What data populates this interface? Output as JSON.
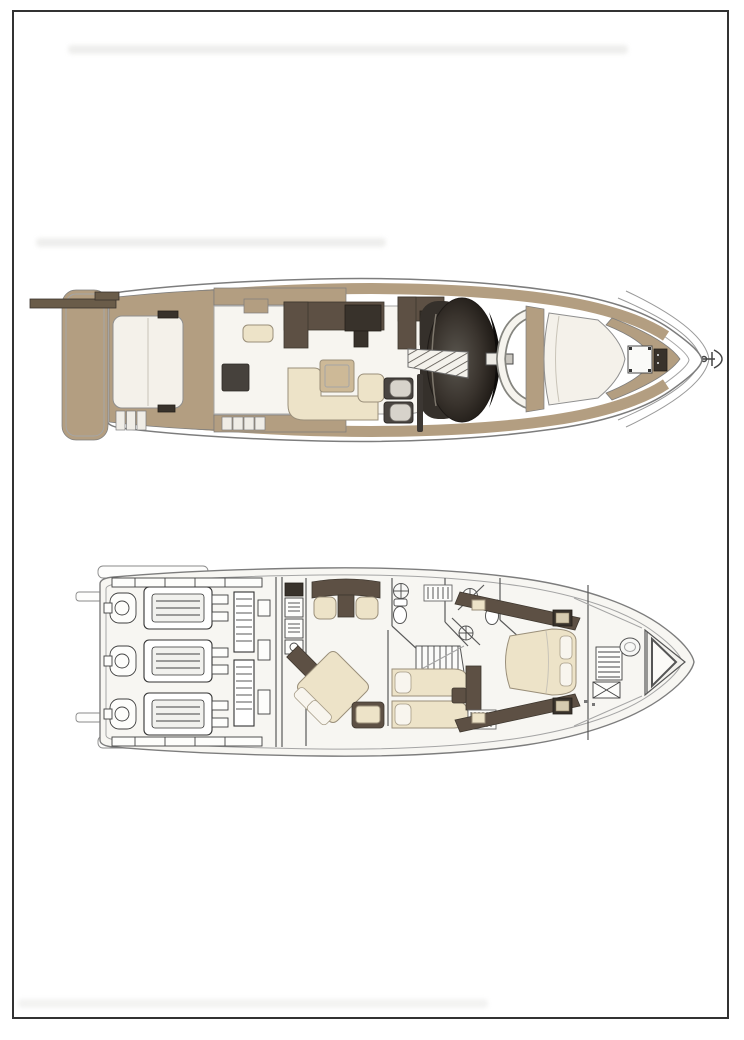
{
  "page": {
    "background": "#ffffff"
  },
  "frame": {
    "color": "#323232",
    "thickness_px": 2
  },
  "palette": {
    "paper": "#ffffff",
    "frame": "#323232",
    "deck-tan": "#b39e81",
    "wood-dark": "#6a5c49",
    "furniture-brown": "#5d5044",
    "furniture-brown-deep": "#38322b",
    "cushion-cream": "#ede3c8",
    "cushion-white": "#f4f1ea",
    "table-tan": "#cdb997",
    "glass-dark": "#27221f",
    "seat-gray": "#d7d3cb",
    "line-mid": "#7d7d7d",
    "line-light": "#a5a5a5",
    "floor-white": "#f7f6f2",
    "artifact-gray": "#e9e9e7"
  },
  "plans": {
    "upper_deck": {
      "name": "flybridge-and-main-deck-plan"
    },
    "lower_deck": {
      "name": "lower-deck-accommodation-and-engine-room-plan"
    }
  },
  "scan_artifacts": {
    "smudge_band_color": "#e9e9e7"
  }
}
